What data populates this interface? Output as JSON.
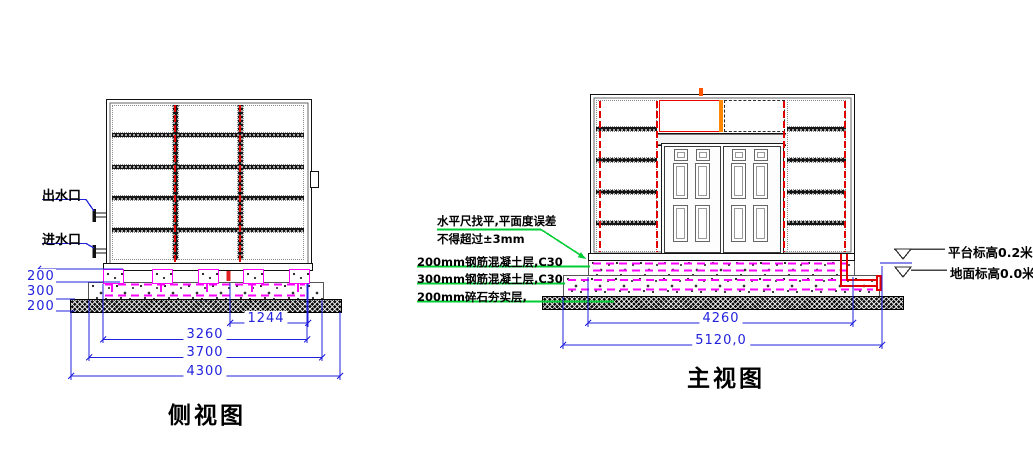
{
  "side_view": {
    "title": "侧视图",
    "outlet_label": "出水口",
    "inlet_label": "进水口",
    "layer_dims": [
      "200",
      "300",
      "200"
    ],
    "width_dims": [
      "1244",
      "3260",
      "3700",
      "4300"
    ]
  },
  "front_view": {
    "title": "主视图",
    "width_dims": [
      "4260",
      "5120,0"
    ],
    "platform_elevation_label": "平台标高0.2米",
    "ground_elevation_label": "地面标高0.0米"
  },
  "annotations": {
    "leveling_note_line1": "水平尺找平,平面度误差",
    "leveling_note_line2": "不得超过±3mm",
    "layer_labels": [
      "200mm钢筋混凝土层,C30",
      "300mm钢筋混凝土层,C30",
      "200mm碎石夯实层,"
    ]
  },
  "colors": {
    "dimension_blue": "#2222dd",
    "leader_green": "#00cc33",
    "rebar_magenta": "#ff00ff",
    "pipe_red": "#ee0000",
    "ground_line_blue": "#8888eb"
  }
}
